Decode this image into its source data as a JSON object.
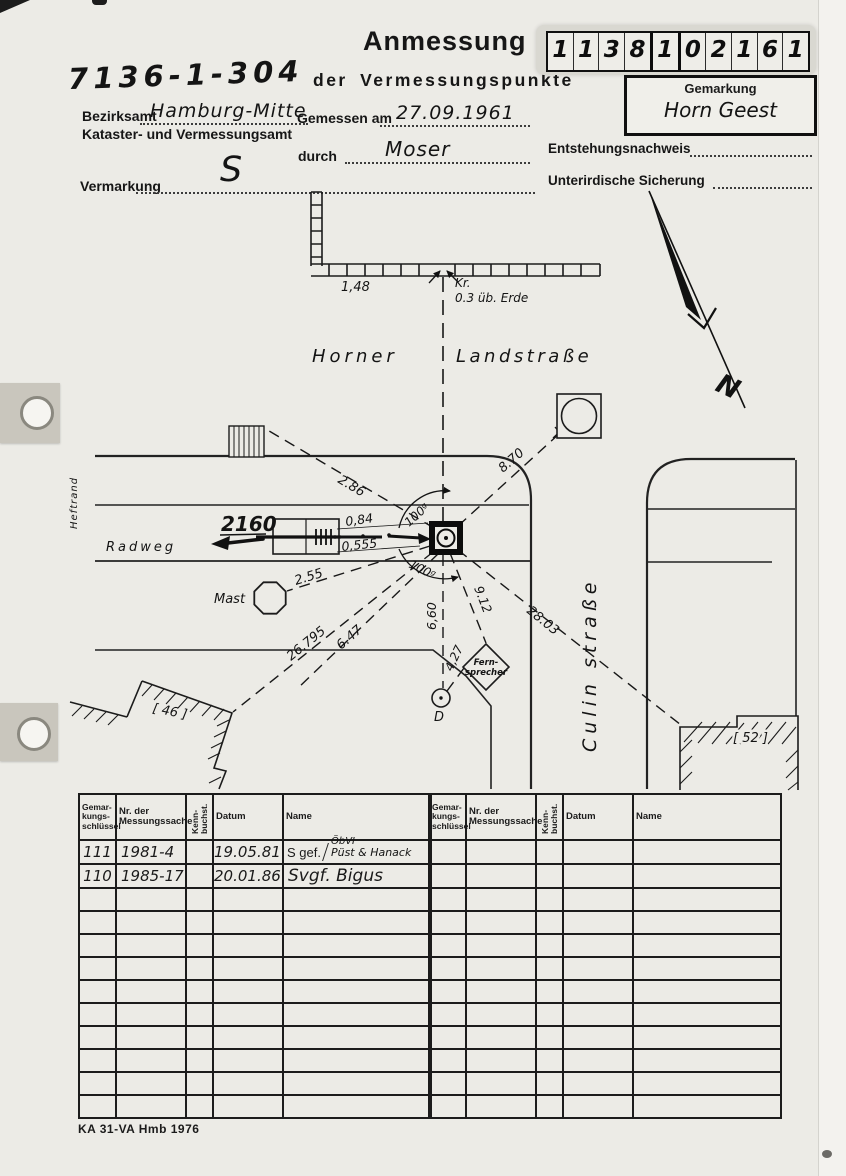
{
  "header": {
    "file_number": "7136-1-304",
    "title": "Anmessung",
    "subtitle": "der Vermessungspunkte",
    "id_digits": [
      "1",
      "1",
      "3",
      "8",
      "1",
      "0",
      "2",
      "1",
      "6",
      "1"
    ],
    "gemarkung": {
      "label": "Gemarkung",
      "value": "Horn Geest"
    },
    "fields": {
      "bezirksamt_label": "Bezirksamt",
      "bezirksamt_value": "Hamburg-Mitte",
      "amt_line2": "Kataster- und Vermessungsamt",
      "gemessen_label": "Gemessen am",
      "gemessen_value": "27.09.1961",
      "durch_label": "durch",
      "durch_value": "Moser",
      "entstehung_label": "Entstehungsnachweis",
      "sicherung_label": "Unterirdische Sicherung",
      "vermarkung_label": "Vermarkung",
      "vermarkung_value": "S"
    }
  },
  "sketch": {
    "heftrand": "Heftrand",
    "street_name_left": "Horner",
    "street_name_right": "Landstraße",
    "street_vertical": "Culin straße",
    "radweg": "Radweg",
    "mast": "Mast",
    "fernsprecher_line1": "Fern-",
    "fernsprecher_line2": "sprecher",
    "point_d": "D",
    "house_left": "[ 46 ]",
    "house_right": "[ 52 ]",
    "kr": "Kr.",
    "kr_note": "0.3 üb. Erde",
    "target_point": "2160",
    "angle_upper": "100ᵍ",
    "angle_lower": "100ᵍ",
    "m_wall": "1,48",
    "m_286": "2.86",
    "m_870": "8.70",
    "m_084": "0,84",
    "m_0555": "0,555",
    "m_255": "2.55",
    "m_912": "9.12",
    "m_2803": "28.03",
    "m_660": "6,60",
    "m_427": "4,27",
    "m_647": "6.47",
    "m_26795": "26.795"
  },
  "table": {
    "headers": {
      "gemarkung": "Gemar-\nkungs-\nschlüssel",
      "nr": "Nr. der\nMessungssache",
      "kenn": "Kenn-\nbuchst.",
      "datum": "Datum",
      "name": "Name"
    },
    "rows": [
      {
        "schluessel": "111",
        "sache": "1981-4",
        "datum": "19.05.81",
        "name_prefix": "S gef.",
        "name_top": "ÖbVI",
        "name_bottom": "Püst & Hanack"
      },
      {
        "schluessel": "110",
        "sache": "1985-17",
        "datum": "20.01.86",
        "name_prefix": "Svgf. Bigus",
        "name_top": "",
        "name_bottom": ""
      }
    ]
  },
  "page": {
    "footer": "KA 31-VA Hmb 1976"
  }
}
